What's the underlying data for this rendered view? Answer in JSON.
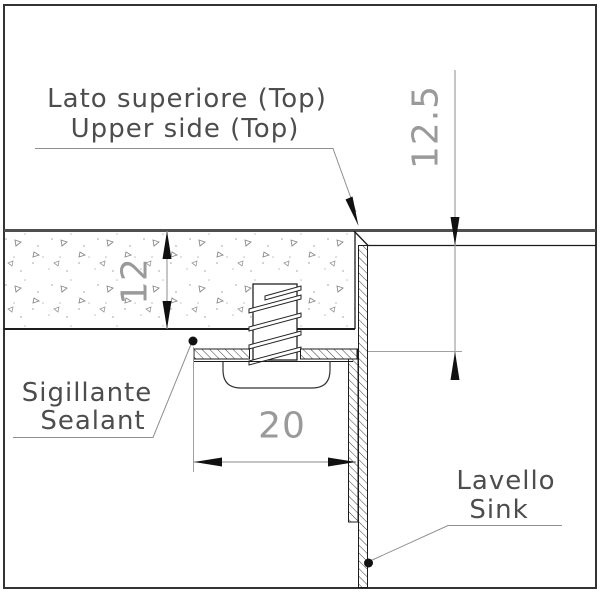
{
  "drawing": {
    "title_context": "Sink mounting section detail",
    "callouts": {
      "top_side_it": "Lato superiore (Top)",
      "top_side_en": "Upper side (Top)",
      "sealant_it": "Sigillante",
      "sealant_en": "Sealant",
      "sink_it": "Lavello",
      "sink_en": "Sink"
    },
    "dimensions": {
      "countertop_thickness": "12",
      "sink_edge_height": "12.5",
      "flange_width": "20"
    },
    "colors": {
      "background": "#ffffff",
      "main_line": "#1c1c1c",
      "counter_top_line": "#4f4f4f",
      "dimension_line": "#a0a0a0",
      "dimension_text": "#9a9a9a",
      "label_text": "#4d4d4d",
      "hatch": "#3f3f3f"
    }
  }
}
